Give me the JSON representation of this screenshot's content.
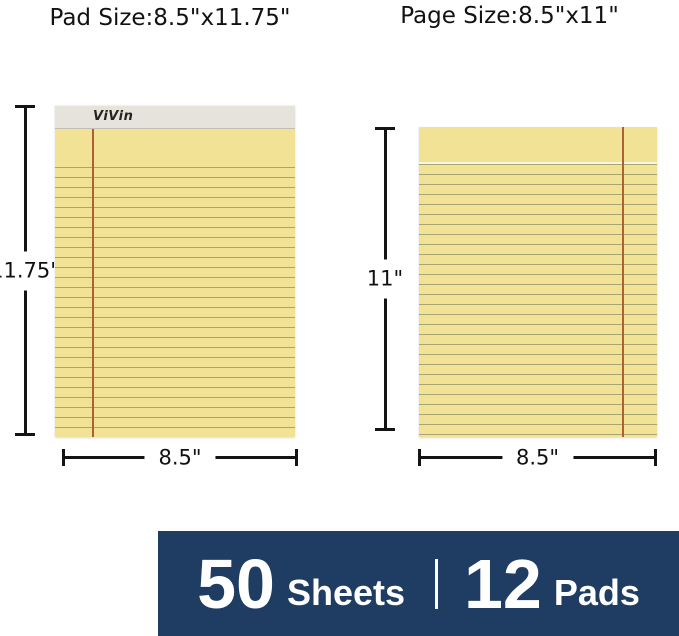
{
  "header": {
    "pad_size_label": "Pad Size:8.5\"x11.75\"",
    "page_size_label": "Page Size:8.5\"x11\""
  },
  "pad": {
    "brand": "ViVin",
    "height_label": "11.75\"",
    "width_label": "8.5\""
  },
  "page": {
    "height_label": "11\"",
    "width_label": "8.5\""
  },
  "banner": {
    "sheets_count": "50",
    "sheets_label": "Sheets",
    "pads_count": "12",
    "pads_label": "Pads"
  },
  "colors": {
    "paper_yellow": "#f1e295",
    "rule_line": "#8f8f68",
    "margin_line": "#ad6030",
    "binding_gray": "#e6e3dd",
    "banner_navy": "#1f3d63",
    "dimension_black": "#141414"
  }
}
